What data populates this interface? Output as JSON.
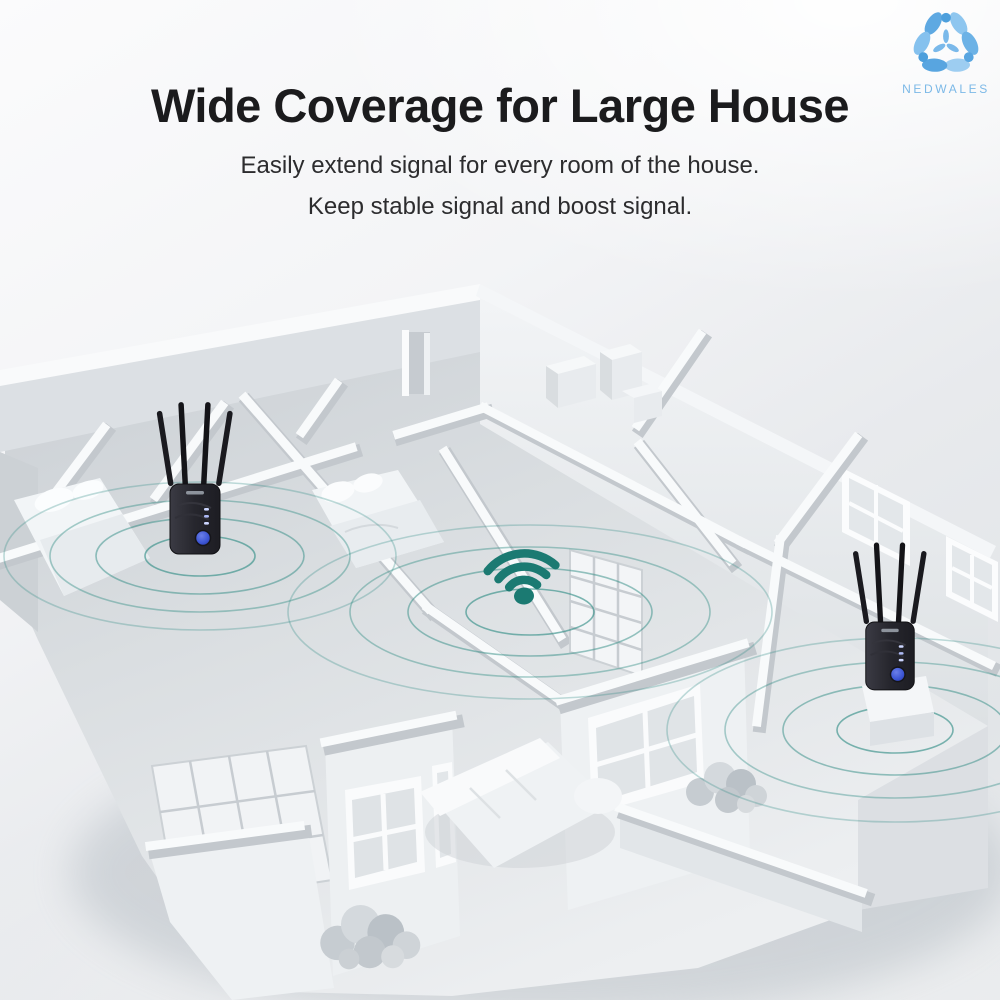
{
  "brand": {
    "name": "NEDWALES",
    "logo_icon": "nedwales-flower-icon",
    "logo_color": "#7cb9e7"
  },
  "header": {
    "title": "Wide Coverage for Large House",
    "subtitle_line1": "Easily extend signal for every room of the house.",
    "subtitle_line2": "Keep stable signal and boost signal."
  },
  "palette": {
    "title_color": "#1b1b1d",
    "subtitle_color": "#2c2c2e",
    "wifi_teal": "#1b7a72",
    "ripple_teal": "#2f8c84",
    "device_body_black": "#26262c",
    "device_button_blue": "#3c55d4",
    "house_white": "#f7f9fa",
    "floor_gray": "#d8dce0",
    "background_top": "#fbfbfc",
    "background_bottom": "#e4e7ea"
  },
  "scene": {
    "illustration": "3d-house-floorplan-wifi-coverage",
    "signal_sources": [
      {
        "type": "wifi-extender",
        "icon": "extender-4-antenna",
        "location": "left-bedroom"
      },
      {
        "type": "wifi-signal",
        "icon": "wifi-icon",
        "location": "center-hallway"
      },
      {
        "type": "wifi-extender",
        "icon": "extender-4-antenna",
        "location": "right-room"
      }
    ]
  }
}
